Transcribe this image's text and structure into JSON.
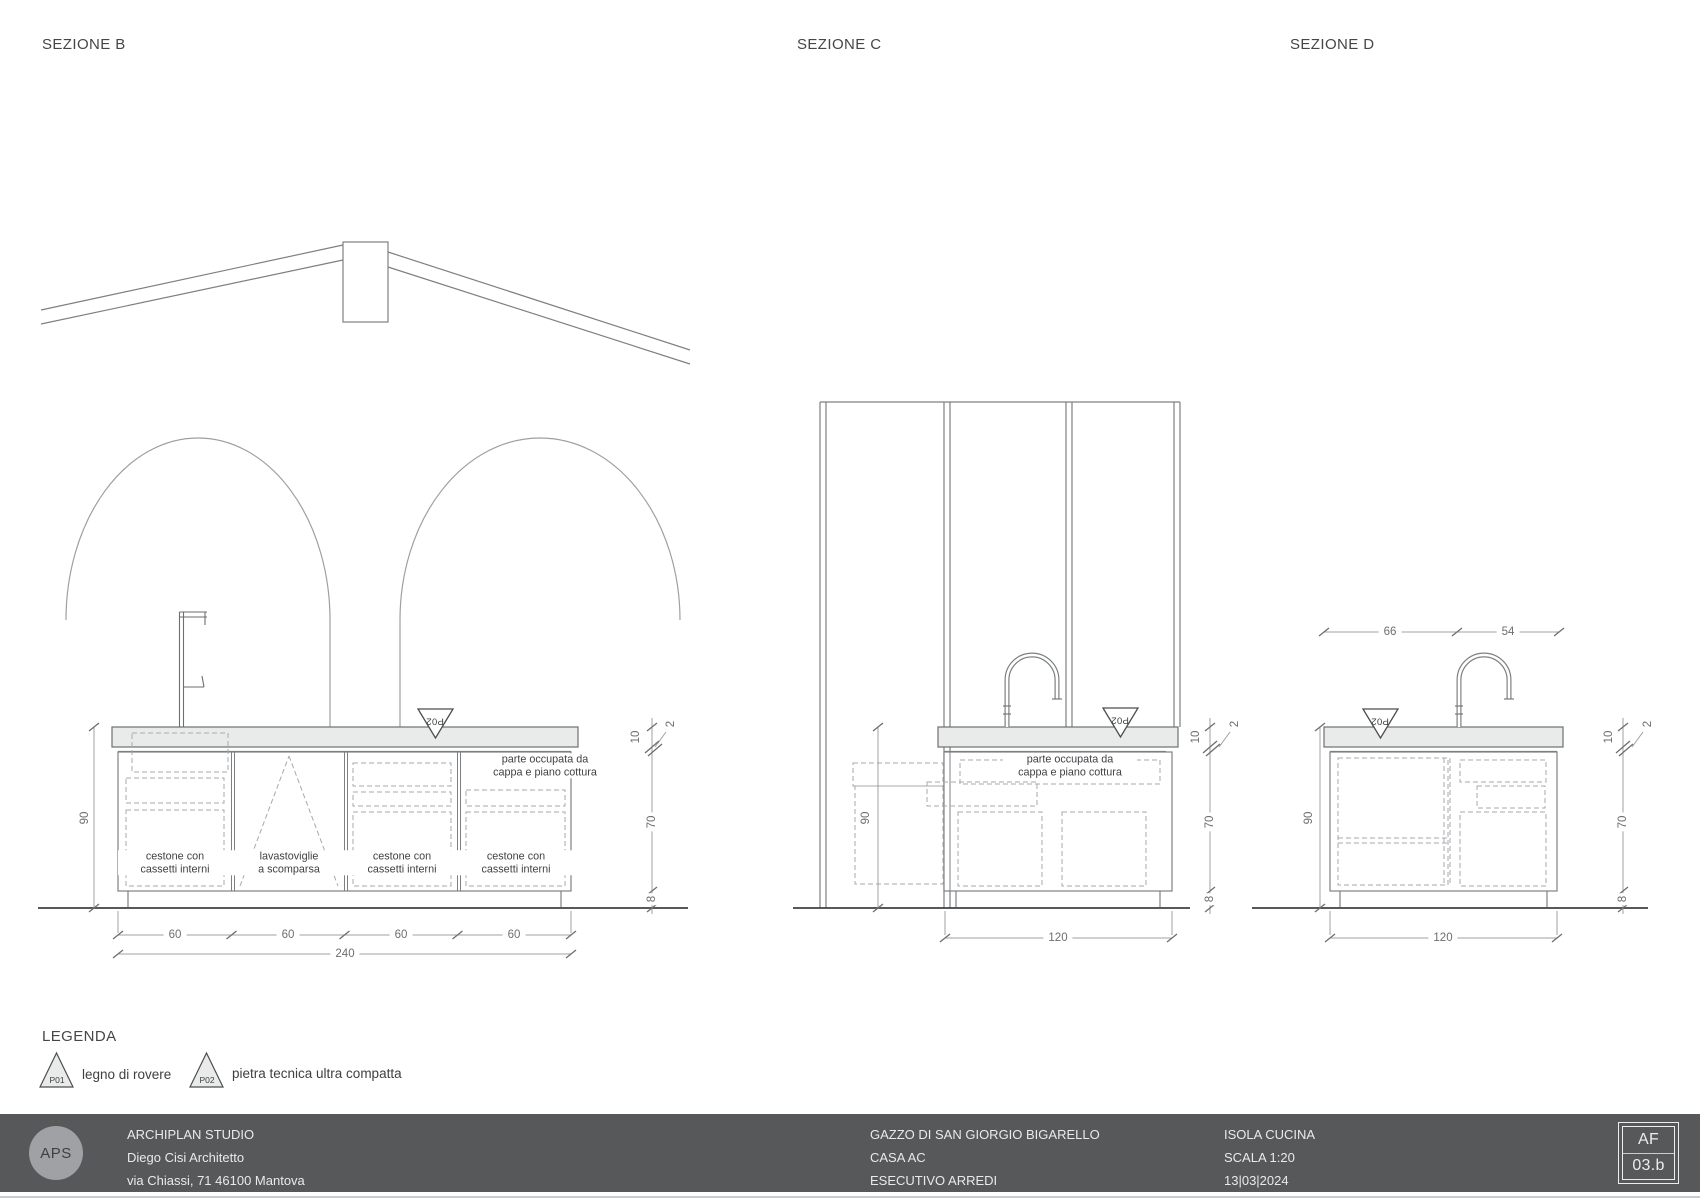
{
  "sections": {
    "b": {
      "title": "SEZIONE B",
      "marker": "P02",
      "hood_label": "parte occupata da\ncappa e piano cottura",
      "modules": [
        "cestone con\ncassetti interni",
        "lavastoviglie\na scomparsa",
        "cestone con\ncassetti interni",
        "cestone con\ncassetti interni"
      ],
      "dim_height": "90",
      "dim_top": "10",
      "dim_edge": "2",
      "dim_body": "70",
      "dim_plinth": "8",
      "dims_bottom": [
        "60",
        "60",
        "60",
        "60"
      ],
      "dim_total": "240"
    },
    "c": {
      "title": "SEZIONE C",
      "marker": "P02",
      "hood_label": "parte occupata da\ncappa e piano cottura",
      "dim_height": "90",
      "dim_top": "10",
      "dim_edge": "2",
      "dim_body": "70",
      "dim_plinth": "8",
      "dim_width": "120"
    },
    "d": {
      "title": "SEZIONE D",
      "marker": "P02",
      "dim_top_left": "66",
      "dim_top_right": "54",
      "dim_height": "90",
      "dim_top": "10",
      "dim_edge": "2",
      "dim_body": "70",
      "dim_plinth": "8",
      "dim_width": "120"
    }
  },
  "legend": {
    "heading": "LEGENDA",
    "items": [
      {
        "code": "P01",
        "label": "legno di rovere"
      },
      {
        "code": "P02",
        "label": "pietra tecnica ultra compatta"
      }
    ]
  },
  "footer": {
    "logo": "APS",
    "studio": [
      "ARCHIPLAN STUDIO",
      "Diego Cisi Architetto",
      "via Chiassi, 71 46100 Mantova"
    ],
    "project": [
      "GAZZO DI SAN GIORGIO BIGARELLO",
      "CASA AC",
      "ESECUTIVO ARREDI"
    ],
    "sheet": [
      "ISOLA CUCINA",
      "SCALA 1:20",
      "13|03|2024"
    ],
    "code_top": "AF",
    "code_bottom": "03.b"
  }
}
